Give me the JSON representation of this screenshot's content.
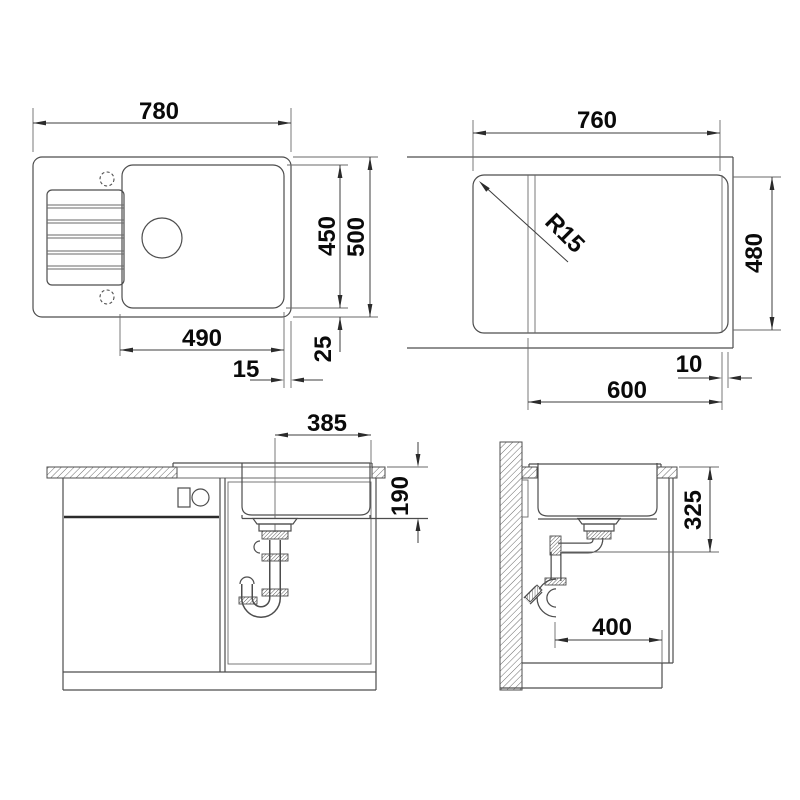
{
  "drawing": {
    "title": "sink-technical-dimension-drawing",
    "line_color": "#4d4d4d",
    "text_color": "#0a0a0a",
    "views": {
      "plan": {
        "label_width": "780",
        "label_bowl_height": "450",
        "label_outer_height": "500",
        "label_bowl_width": "490",
        "label_right_offset": "15",
        "label_bottom_offset": "25"
      },
      "underside": {
        "label_width": "760",
        "label_radius": "R15",
        "label_height": "480",
        "label_bowl": "600",
        "label_edge": "10"
      },
      "front_section": {
        "label_drain_offset": "385",
        "label_bowl_depth": "190"
      },
      "side_section": {
        "label_outlet_height": "325",
        "label_clearance": "400"
      }
    }
  }
}
